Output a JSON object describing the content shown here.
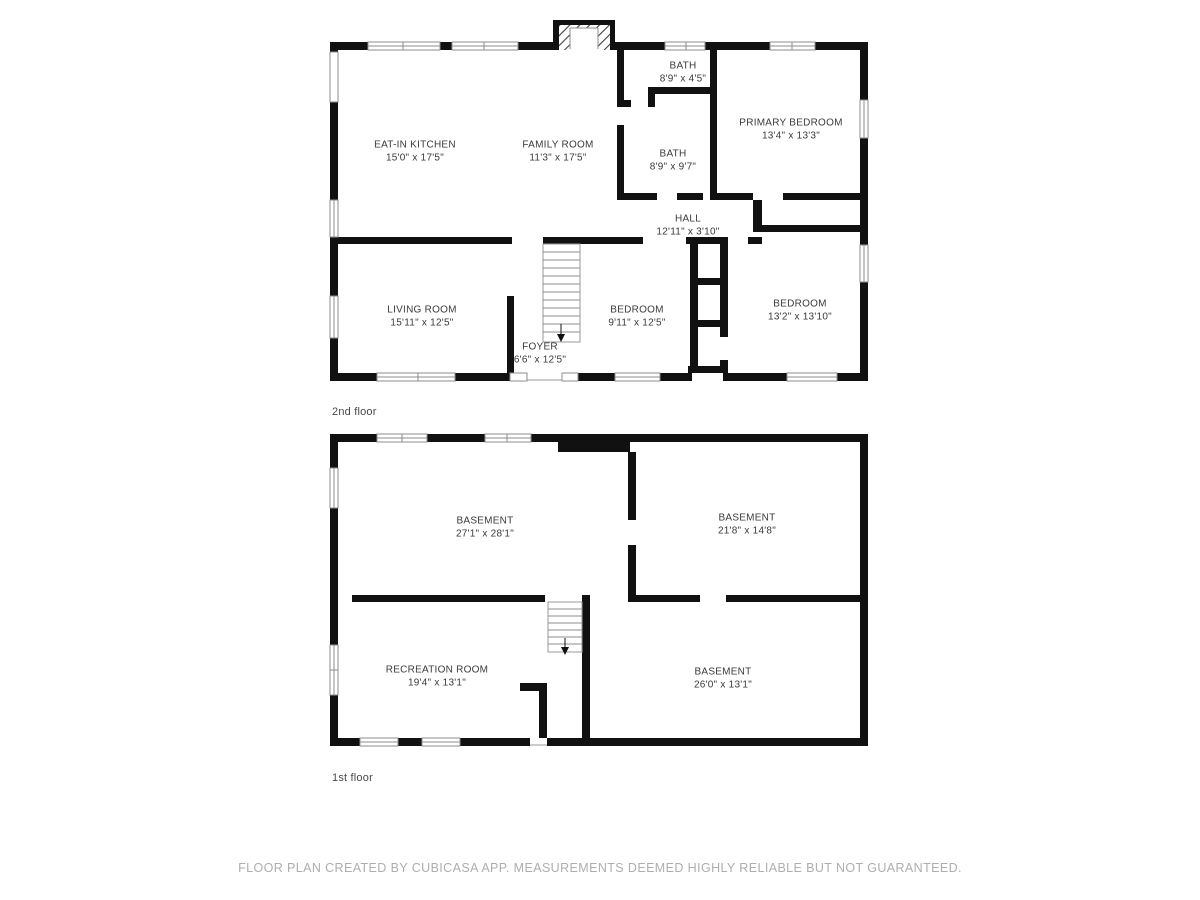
{
  "colors": {
    "wall": "#111111",
    "window_frame": "#8e8e8e",
    "stair_line": "#8c8c8c",
    "room_text": "#3a3a3a",
    "floor_label_text": "#484848",
    "footer_text": "#aeaeae"
  },
  "footer": {
    "text": "FLOOR PLAN CREATED BY CUBICASA APP. MEASUREMENTS DEEMED HIGHLY RELIABLE BUT NOT GUARANTEED."
  },
  "floors": [
    {
      "id": "2nd-floor",
      "label": "2nd floor",
      "rooms": [
        {
          "name": "EAT-IN KITCHEN",
          "dims": "15'0\" x 17'5\"",
          "x": 415,
          "y": 152
        },
        {
          "name": "FAMILY ROOM",
          "dims": "11'3\" x 17'5\"",
          "x": 558,
          "y": 152
        },
        {
          "name": "BATH",
          "dims": "8'9\" x 4'5\"",
          "x": 683,
          "y": 73
        },
        {
          "name": "PRIMARY BEDROOM",
          "dims": "13'4\" x 13'3\"",
          "x": 791,
          "y": 130
        },
        {
          "name": "BATH",
          "dims": "8'9\" x 9'7\"",
          "x": 673,
          "y": 161
        },
        {
          "name": "HALL",
          "dims": "12'11\" x 3'10\"",
          "x": 688,
          "y": 226
        },
        {
          "name": "LIVING ROOM",
          "dims": "15'11\" x 12'5\"",
          "x": 422,
          "y": 317
        },
        {
          "name": "BEDROOM",
          "dims": "9'11\" x 12'5\"",
          "x": 637,
          "y": 317
        },
        {
          "name": "BEDROOM",
          "dims": "13'2\" x 13'10\"",
          "x": 800,
          "y": 311
        },
        {
          "name": "FOYER",
          "dims": "6'6\" x 12'5\"",
          "x": 540,
          "y": 354
        }
      ]
    },
    {
      "id": "1st-floor",
      "label": "1st floor",
      "rooms": [
        {
          "name": "BASEMENT",
          "dims": "27'1\" x 28'1\"",
          "x": 485,
          "y": 528
        },
        {
          "name": "BASEMENT",
          "dims": "21'8\" x 14'8\"",
          "x": 747,
          "y": 525
        },
        {
          "name": "RECREATION ROOM",
          "dims": "19'4\" x 13'1\"",
          "x": 437,
          "y": 677
        },
        {
          "name": "BASEMENT",
          "dims": "26'0\" x 13'1\"",
          "x": 723,
          "y": 679
        }
      ]
    }
  ]
}
